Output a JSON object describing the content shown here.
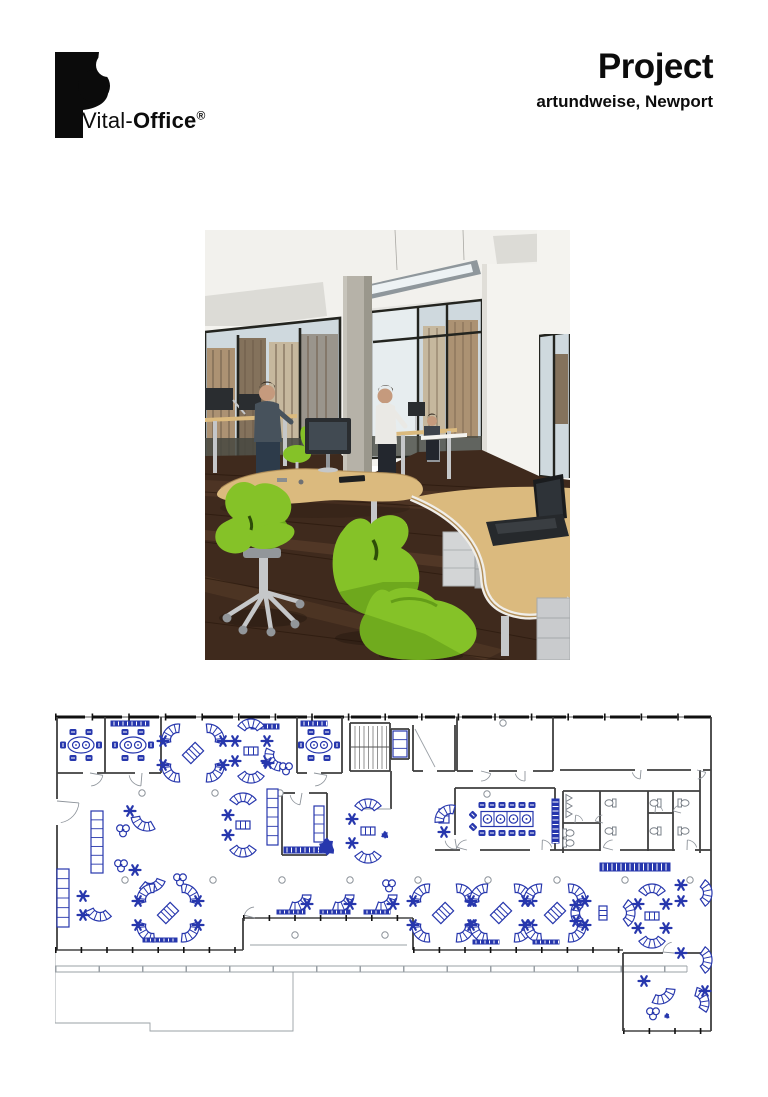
{
  "header": {
    "logo": {
      "brand_prefix": "Vital-",
      "brand_suffix": "Office",
      "registered": "®"
    },
    "title": "Project",
    "subtitle": "artundweise, Newport"
  },
  "photo": {
    "colors": {
      "ceiling": "#f2f1ed",
      "panel": "#dcdbd6",
      "panel2": "#e6e5e1",
      "light_frame": "#8f979c",
      "light_lit": "#edf2f4",
      "wall": "#f4f3ef",
      "wall_shade": "#e0ded8",
      "glass": "#cfd9de",
      "glass_lit": "#e7edef",
      "frame": "#23241f",
      "bldg1": "#ac9273",
      "bldg2": "#84725c",
      "bldg3": "#c6b89e",
      "column": "#b6b2a8",
      "column_shade": "#8f8b80",
      "floor": "#3f2a1d",
      "floor_mid": "#5a3d29",
      "floor_light": "#74513a",
      "desk": "#dbba7e",
      "desk_edge": "#b18e58",
      "metal": "#c5c7c9",
      "metal_dark": "#92969a",
      "screen": "#2a2d30",
      "screen_glow": "#414a52",
      "laptop": "#1a1c1e",
      "chair": "#85c228",
      "chair_dark": "#5b9414",
      "skin": "#c59a7d",
      "hair": "#332a22",
      "shirt_dark": "#47525c",
      "shirt_white": "#eae9e5",
      "jeans": "#2d3b4a",
      "pants_dark": "#23272e",
      "shadow": "rgba(25,15,8,0.32)"
    }
  },
  "floorplan": {
    "colors": {
      "furniture": "#2737ad",
      "wall": "#3f3f3f",
      "thin": "#9aa0a6",
      "window": "#101010",
      "fixture": "#7a8088"
    },
    "walls": [
      [
        0,
        4,
        656,
        4,
        "win"
      ],
      [
        2,
        4,
        2,
        86,
        "w"
      ],
      [
        2,
        112,
        2,
        237,
        "w"
      ],
      [
        0,
        237,
        188,
        237,
        "winb"
      ],
      [
        188,
        205,
        358,
        205,
        "winb"
      ],
      [
        188,
        205,
        188,
        237,
        "w"
      ],
      [
        358,
        205,
        358,
        237,
        "w"
      ],
      [
        358,
        237,
        568,
        237,
        "winb"
      ],
      [
        656,
        4,
        656,
        318,
        "w"
      ],
      [
        568,
        318,
        656,
        318,
        "winb"
      ],
      [
        568,
        240,
        568,
        318,
        "w"
      ],
      [
        568,
        240,
        608,
        240,
        "w"
      ],
      [
        630,
        240,
        656,
        240,
        "w"
      ],
      [
        2,
        60,
        28,
        60,
        "w"
      ],
      [
        42,
        60,
        80,
        60,
        "w"
      ],
      [
        94,
        60,
        106,
        60,
        "w"
      ],
      [
        50,
        4,
        50,
        60,
        "w"
      ],
      [
        106,
        4,
        106,
        60,
        "w"
      ],
      [
        242,
        4,
        242,
        60,
        "w"
      ],
      [
        287,
        4,
        287,
        60,
        "w"
      ],
      [
        242,
        60,
        252,
        60,
        "w"
      ],
      [
        266,
        60,
        287,
        60,
        "w"
      ],
      [
        295,
        10,
        335,
        10,
        "w"
      ],
      [
        295,
        10,
        295,
        58,
        "w"
      ],
      [
        335,
        10,
        335,
        58,
        "w"
      ],
      [
        295,
        58,
        335,
        58,
        "w"
      ],
      [
        336,
        16,
        354,
        16,
        "w"
      ],
      [
        336,
        16,
        336,
        46,
        "w"
      ],
      [
        354,
        16,
        354,
        46,
        "w"
      ],
      [
        336,
        46,
        354,
        46,
        "w"
      ],
      [
        358,
        12,
        358,
        58,
        "w"
      ],
      [
        400,
        12,
        400,
        58,
        "w"
      ],
      [
        358,
        58,
        368,
        58,
        "w"
      ],
      [
        382,
        58,
        400,
        58,
        "w"
      ],
      [
        360,
        16,
        380,
        54,
        "t"
      ],
      [
        402,
        4,
        402,
        58,
        "w"
      ],
      [
        498,
        4,
        498,
        58,
        "w"
      ],
      [
        402,
        58,
        418,
        58,
        "w"
      ],
      [
        434,
        58,
        462,
        58,
        "w"
      ],
      [
        478,
        58,
        498,
        58,
        "w"
      ],
      [
        505,
        57,
        580,
        57,
        "w"
      ],
      [
        592,
        57,
        636,
        57,
        "w"
      ],
      [
        648,
        57,
        656,
        57,
        "w"
      ],
      [
        508,
        78,
        645,
        78,
        "w"
      ],
      [
        508,
        78,
        508,
        140,
        "w"
      ],
      [
        645,
        57,
        645,
        140,
        "w"
      ],
      [
        545,
        78,
        545,
        138,
        "w"
      ],
      [
        593,
        78,
        593,
        138,
        "w"
      ],
      [
        618,
        78,
        618,
        138,
        "w"
      ],
      [
        508,
        110,
        545,
        110,
        "w"
      ],
      [
        593,
        100,
        618,
        100,
        "w"
      ],
      [
        400,
        75,
        400,
        122,
        "w"
      ],
      [
        400,
        75,
        500,
        75,
        "w"
      ],
      [
        500,
        75,
        500,
        137,
        "w"
      ],
      [
        380,
        137,
        405,
        137,
        "w"
      ],
      [
        425,
        137,
        475,
        137,
        "w"
      ],
      [
        495,
        137,
        545,
        137,
        "w"
      ],
      [
        565,
        137,
        620,
        137,
        "w"
      ],
      [
        640,
        137,
        656,
        137,
        "w"
      ],
      [
        227,
        80,
        240,
        80,
        "w"
      ],
      [
        254,
        80,
        272,
        80,
        "w"
      ],
      [
        227,
        80,
        227,
        142,
        "w"
      ],
      [
        272,
        80,
        272,
        142,
        "w"
      ],
      [
        227,
        142,
        272,
        142,
        "w"
      ],
      [
        336,
        58,
        336,
        96,
        "w"
      ],
      [
        305,
        96,
        336,
        96,
        "t"
      ],
      [
        0,
        256,
        632,
        256,
        "fence"
      ]
    ],
    "thin_paths": [
      "M0,253 H632",
      "M0,259 H632",
      "M0,237 L0,310 L95,310 L95,318 L238,318 L238,259",
      "M632,253 V259",
      "M195,232 H352"
    ],
    "doors": [
      [
        35,
        60,
        13,
        10,
        85
      ],
      [
        87,
        60,
        13,
        95,
        170
      ],
      [
        259,
        60,
        13,
        10,
        85
      ],
      [
        2,
        88,
        22,
        5,
        80
      ],
      [
        426,
        58,
        10,
        15,
        90
      ],
      [
        470,
        58,
        10,
        90,
        165
      ],
      [
        412,
        137,
        10,
        195,
        268
      ],
      [
        487,
        137,
        10,
        272,
        345
      ],
      [
        558,
        137,
        10,
        195,
        268
      ],
      [
        632,
        137,
        10,
        272,
        345
      ],
      [
        247,
        80,
        12,
        100,
        170
      ],
      [
        619,
        240,
        11,
        185,
        258
      ],
      [
        200,
        205,
        11,
        195,
        265
      ],
      [
        586,
        57,
        9,
        95,
        165
      ],
      [
        642,
        57,
        9,
        15,
        85
      ],
      [
        400,
        126,
        10,
        80,
        170
      ],
      [
        520,
        110,
        8,
        275,
        345
      ],
      [
        548,
        110,
        8,
        195,
        265
      ],
      [
        600,
        100,
        8,
        275,
        345
      ],
      [
        626,
        100,
        8,
        195,
        265
      ]
    ],
    "columns": [
      [
        87,
        80
      ],
      [
        160,
        80
      ],
      [
        225,
        80
      ],
      [
        448,
        10
      ],
      [
        432,
        81
      ],
      [
        70,
        167
      ],
      [
        158,
        167
      ],
      [
        227,
        167
      ],
      [
        295,
        167
      ],
      [
        363,
        167
      ],
      [
        433,
        167
      ],
      [
        502,
        167
      ],
      [
        570,
        167
      ],
      [
        635,
        167
      ],
      [
        240,
        222
      ],
      [
        330,
        222
      ]
    ],
    "furniture": [
      {
        "t": "oval",
        "x": 26,
        "y": 32
      },
      {
        "t": "oval",
        "x": 78,
        "y": 32
      },
      {
        "t": "oval",
        "x": 264,
        "y": 32
      },
      {
        "t": "counter",
        "x": 56,
        "y": 8,
        "w": 38,
        "h": 5
      },
      {
        "t": "counter",
        "x": 196,
        "y": 11,
        "w": 28,
        "h": 5
      },
      {
        "t": "counter",
        "x": 246,
        "y": 8,
        "w": 26,
        "h": 5
      },
      {
        "t": "x",
        "x": 138,
        "y": 40
      },
      {
        "t": "pair",
        "x": 196,
        "y": 38,
        "a": 90
      },
      {
        "t": "star",
        "x": 180,
        "y": 28
      },
      {
        "t": "star",
        "x": 180,
        "y": 48
      },
      {
        "t": "star",
        "x": 212,
        "y": 28
      },
      {
        "t": "star",
        "x": 212,
        "y": 48
      },
      {
        "t": "crescent",
        "x": 226,
        "y": 42,
        "a": 150
      },
      {
        "t": "star",
        "x": 213,
        "y": 50
      },
      {
        "t": "trefoil",
        "x": 231,
        "y": 55
      },
      {
        "t": "shelf",
        "x": 36,
        "y": 98,
        "w": 12,
        "h": 62
      },
      {
        "t": "crescent",
        "x": 92,
        "y": 102,
        "a": 115
      },
      {
        "t": "star",
        "x": 75,
        "y": 98
      },
      {
        "t": "trefoil",
        "x": 68,
        "y": 117
      },
      {
        "t": "trefoil",
        "x": 66,
        "y": 152
      },
      {
        "t": "star",
        "x": 80,
        "y": 157
      },
      {
        "t": "crescent",
        "x": 95,
        "y": 163,
        "a": 75
      },
      {
        "t": "shelf",
        "x": 212,
        "y": 76,
        "w": 11,
        "h": 56
      },
      {
        "t": "pair",
        "x": 188,
        "y": 112,
        "a": 90
      },
      {
        "t": "star",
        "x": 173,
        "y": 102
      },
      {
        "t": "star",
        "x": 173,
        "y": 122
      },
      {
        "t": "counter",
        "x": 229,
        "y": 134,
        "w": 42,
        "h": 6
      },
      {
        "t": "shelf",
        "x": 259,
        "y": 93,
        "w": 10,
        "h": 36
      },
      {
        "t": "plant",
        "x": 272,
        "y": 134,
        "r": 9
      },
      {
        "t": "pair",
        "x": 313,
        "y": 118,
        "a": 90
      },
      {
        "t": "star",
        "x": 297,
        "y": 106
      },
      {
        "t": "star",
        "x": 297,
        "y": 130
      },
      {
        "t": "splat",
        "x": 330,
        "y": 122,
        "r": 4
      },
      {
        "t": "shelf",
        "x": 384,
        "y": 96,
        "w": 10,
        "h": 14
      },
      {
        "t": "crescent",
        "x": 396,
        "y": 108,
        "a": 230
      },
      {
        "t": "star",
        "x": 389,
        "y": 119
      },
      {
        "t": "conf",
        "x": 452,
        "y": 106
      },
      {
        "t": "counter",
        "x": 497,
        "y": 86,
        "w": 7,
        "h": 44
      },
      {
        "t": "sink",
        "x": 511,
        "y": 85
      },
      {
        "t": "sink",
        "x": 511,
        "y": 93
      },
      {
        "t": "sink",
        "x": 511,
        "y": 101
      },
      {
        "t": "toilet",
        "x": 513,
        "y": 120,
        "a": 0
      },
      {
        "t": "toilet",
        "x": 513,
        "y": 130,
        "a": 0
      },
      {
        "t": "toilet",
        "x": 556,
        "y": 90,
        "a": 180
      },
      {
        "t": "toilet",
        "x": 556,
        "y": 118,
        "a": 180
      },
      {
        "t": "toilet",
        "x": 601,
        "y": 90,
        "a": 180
      },
      {
        "t": "toilet",
        "x": 601,
        "y": 118,
        "a": 180
      },
      {
        "t": "toilet",
        "x": 628,
        "y": 90,
        "a": 0
      },
      {
        "t": "toilet",
        "x": 628,
        "y": 118,
        "a": 0
      },
      {
        "t": "counter",
        "x": 545,
        "y": 150,
        "w": 70,
        "h": 8
      },
      {
        "t": "shelf",
        "x": 2,
        "y": 156,
        "w": 12,
        "h": 58
      },
      {
        "t": "crescent",
        "x": 45,
        "y": 192,
        "a": 100
      },
      {
        "t": "star",
        "x": 28,
        "y": 183
      },
      {
        "t": "star",
        "x": 28,
        "y": 202
      },
      {
        "t": "x",
        "x": 113,
        "y": 200
      },
      {
        "t": "counter",
        "x": 88,
        "y": 225,
        "w": 34,
        "h": 4
      },
      {
        "t": "trefoil",
        "x": 125,
        "y": 166
      },
      {
        "t": "crescent",
        "x": 240,
        "y": 182,
        "a": 55
      },
      {
        "t": "star",
        "x": 252,
        "y": 191
      },
      {
        "t": "crescent",
        "x": 283,
        "y": 182,
        "a": 55
      },
      {
        "t": "star",
        "x": 295,
        "y": 191
      },
      {
        "t": "crescent",
        "x": 326,
        "y": 182,
        "a": 55
      },
      {
        "t": "star",
        "x": 338,
        "y": 191
      },
      {
        "t": "counter",
        "x": 222,
        "y": 197,
        "w": 28,
        "h": 4
      },
      {
        "t": "counter",
        "x": 265,
        "y": 197,
        "w": 30,
        "h": 4
      },
      {
        "t": "counter",
        "x": 309,
        "y": 197,
        "w": 26,
        "h": 4
      },
      {
        "t": "trefoil",
        "x": 334,
        "y": 172
      },
      {
        "t": "x",
        "x": 388,
        "y": 200
      },
      {
        "t": "x",
        "x": 446,
        "y": 200
      },
      {
        "t": "x",
        "x": 500,
        "y": 200
      },
      {
        "t": "counter",
        "x": 418,
        "y": 227,
        "w": 26,
        "h": 4
      },
      {
        "t": "counter",
        "x": 478,
        "y": 227,
        "w": 26,
        "h": 4
      },
      {
        "t": "pair",
        "x": 548,
        "y": 200,
        "a": 0
      },
      {
        "t": "star",
        "x": 521,
        "y": 192
      },
      {
        "t": "star",
        "x": 521,
        "y": 208
      },
      {
        "t": "pair",
        "x": 597,
        "y": 203,
        "a": 90
      },
      {
        "t": "star",
        "x": 583,
        "y": 191
      },
      {
        "t": "star",
        "x": 583,
        "y": 215
      },
      {
        "t": "star",
        "x": 611,
        "y": 191
      },
      {
        "t": "star",
        "x": 611,
        "y": 215
      },
      {
        "t": "crescent",
        "x": 641,
        "y": 180,
        "a": 0
      },
      {
        "t": "star",
        "x": 626,
        "y": 172
      },
      {
        "t": "star",
        "x": 626,
        "y": 188
      },
      {
        "t": "crescent",
        "x": 641,
        "y": 247,
        "a": 0
      },
      {
        "t": "star",
        "x": 626,
        "y": 240
      },
      {
        "t": "crescent",
        "x": 604,
        "y": 275,
        "a": 60
      },
      {
        "t": "star",
        "x": 589,
        "y": 268
      },
      {
        "t": "crescent",
        "x": 638,
        "y": 290,
        "a": -20
      },
      {
        "t": "star",
        "x": 650,
        "y": 278
      },
      {
        "t": "trefoil",
        "x": 598,
        "y": 300
      },
      {
        "t": "splat",
        "x": 612,
        "y": 303,
        "r": 3
      },
      {
        "t": "stairs",
        "x": 296,
        "y": 12,
        "w": 38,
        "h": 44
      },
      {
        "t": "shelf",
        "x": 338,
        "y": 18,
        "w": 14,
        "h": 26
      }
    ]
  }
}
